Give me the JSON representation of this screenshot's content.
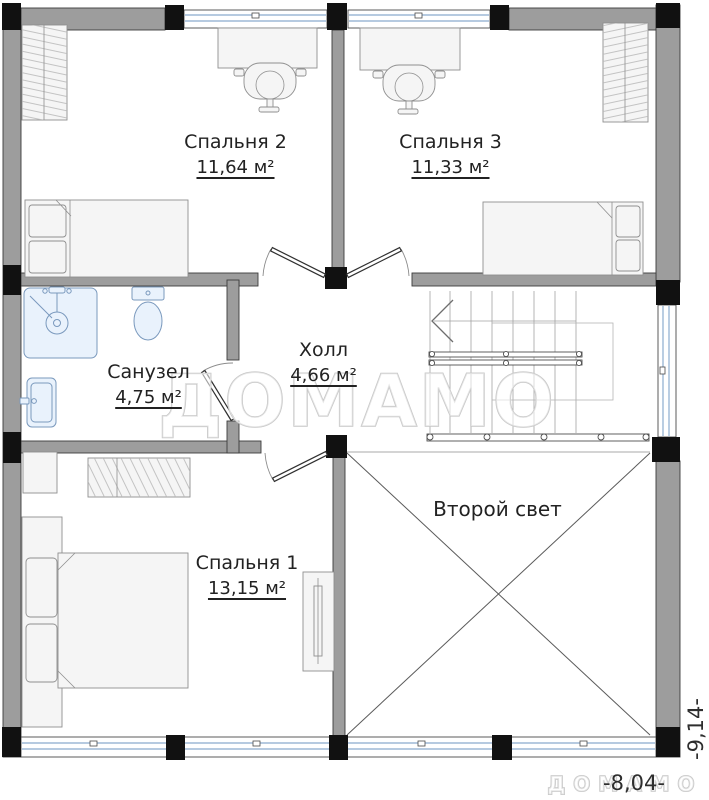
{
  "rooms": {
    "bedroom2": {
      "name": "Спальня 2",
      "area": "11,64 м²"
    },
    "bedroom3": {
      "name": "Спальня 3",
      "area": "11,33 м²"
    },
    "bathroom": {
      "name": "Санузел",
      "area": "4,75 м²"
    },
    "hall": {
      "name": "Холл",
      "area": "4,66 м²"
    },
    "bedroom1": {
      "name": "Спальня 1",
      "area": "13,15 м²"
    },
    "second_light": {
      "name": "Второй свет"
    }
  },
  "dimensions": {
    "width_label": "-8,04-",
    "height_label": "-9,14-"
  },
  "watermark": {
    "text": "ДОМАМО",
    "text_small": "ДОМАМО"
  },
  "colors": {
    "wall": "#9d9d9d",
    "column": "#111111",
    "line": "#3c3c3c",
    "glass": "#9db8d6",
    "fixture-fill": "#e9f2fc",
    "fixture-stroke": "#7a99bd",
    "furniture-fill": "#f5f5f5",
    "furniture-stroke": "#8f8f8f",
    "watermark": "#c8c8c8",
    "text": "#222222"
  }
}
